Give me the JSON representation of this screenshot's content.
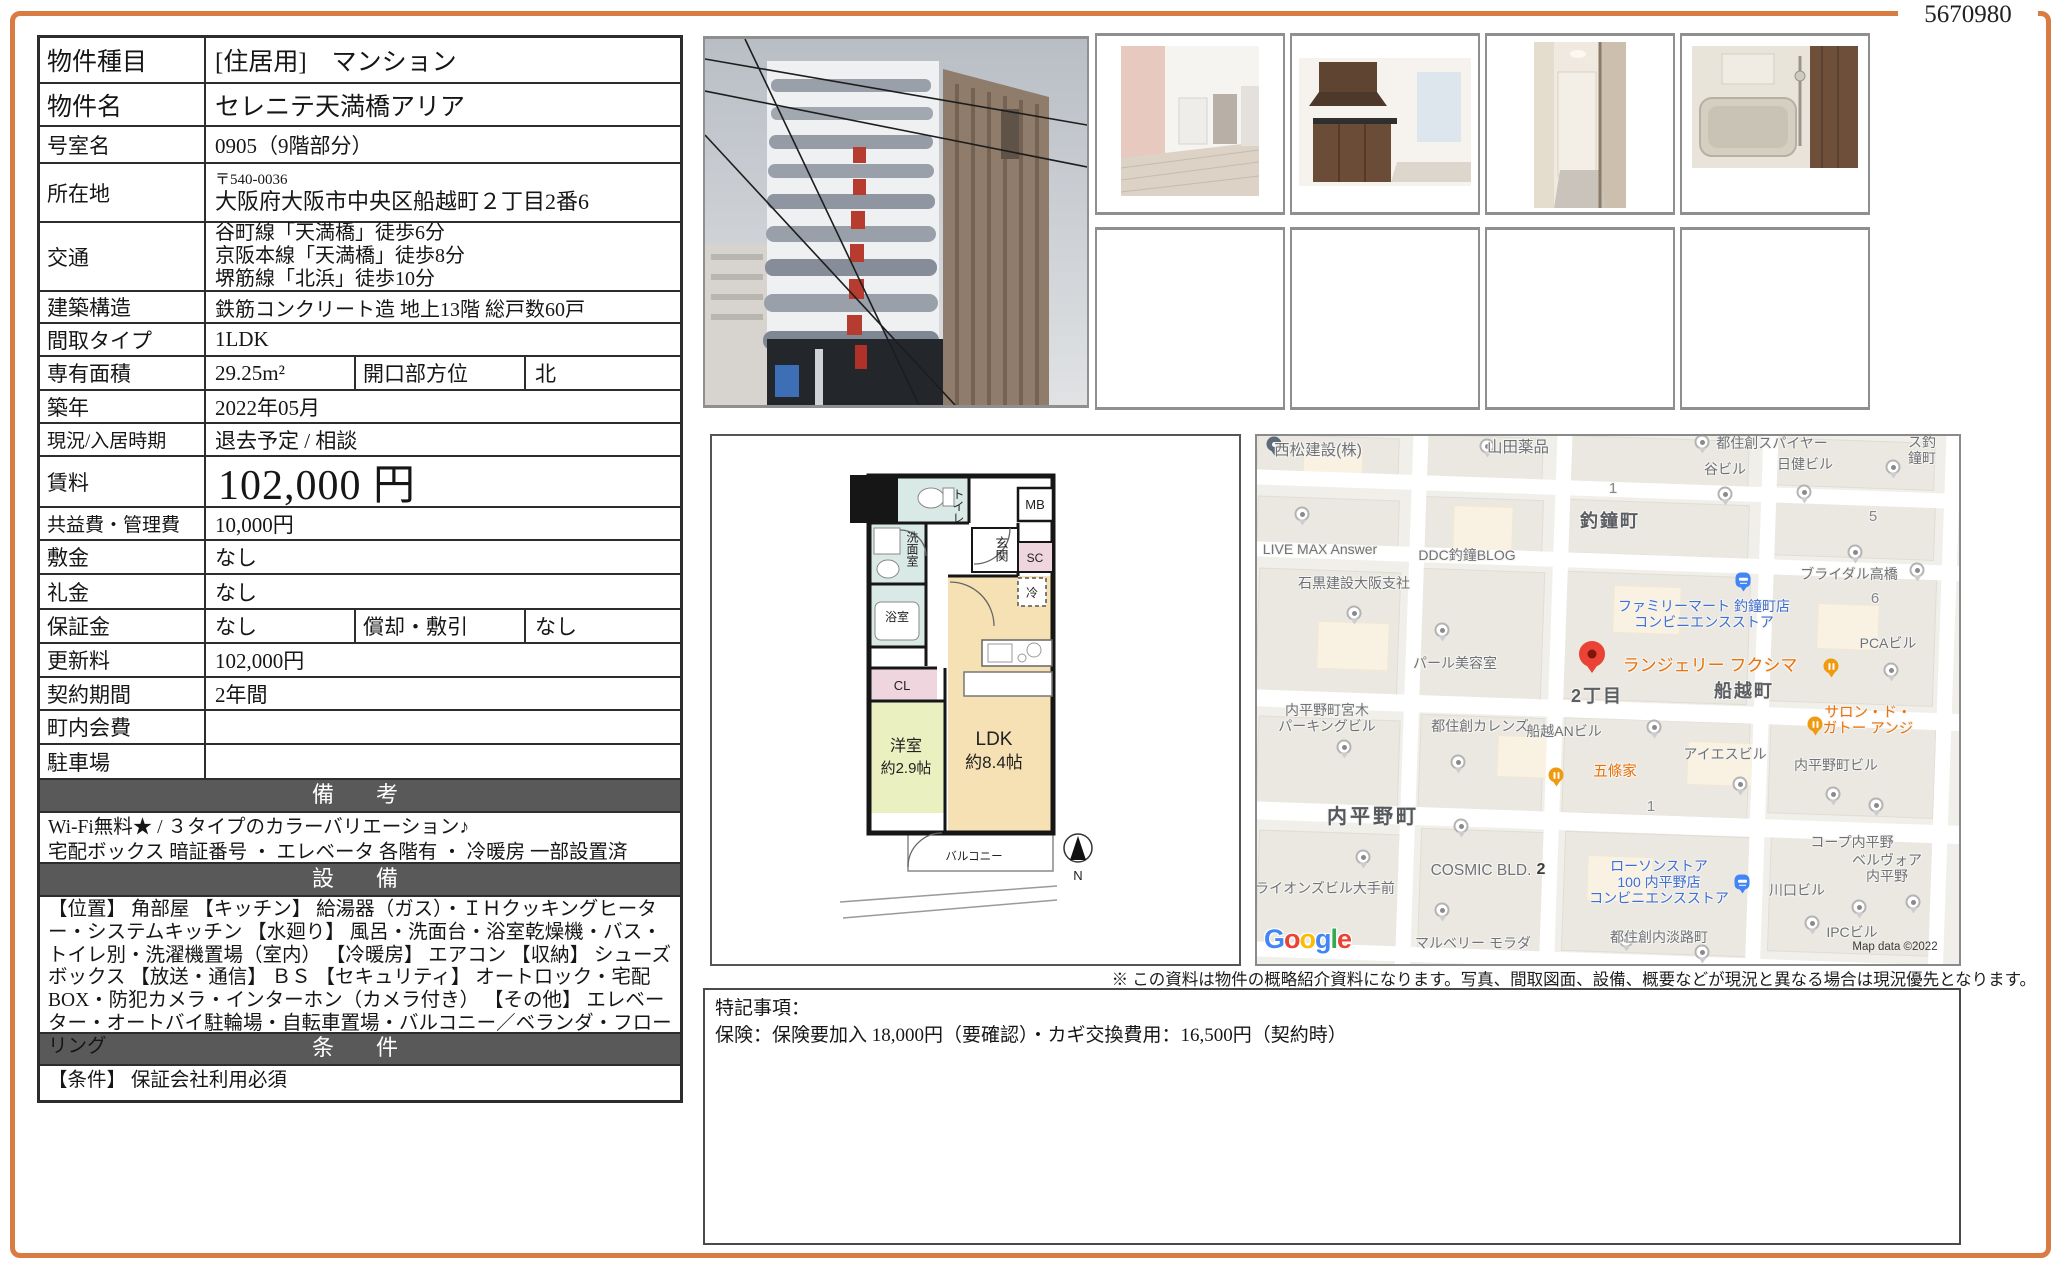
{
  "doc_number": "5670980",
  "table": {
    "rows": [
      {
        "label": "物件種目",
        "value": "[住居用]　マンション"
      },
      {
        "label": "物件名",
        "value": "セレニテ天満橋アリア"
      },
      {
        "label": "号室名",
        "value": "0905（9階部分）"
      },
      {
        "label": "所在地",
        "postal": "〒540-0036",
        "value": "大阪府大阪市中央区船越町２丁目2番6"
      },
      {
        "label": "交通",
        "value": "谷町線「天満橋」徒歩6分\n京阪本線「天満橋」徒歩8分\n堺筋線「北浜」徒歩10分"
      },
      {
        "label": "建築構造",
        "value": "鉄筋コンクリート造 地上13階  総戸数60戸"
      },
      {
        "label": "間取タイプ",
        "value": "1LDK"
      },
      {
        "label": "専有面積",
        "value": "29.25m²",
        "label2": "開口部方位",
        "value2": "北"
      },
      {
        "label": "築年",
        "value": "2022年05月"
      },
      {
        "label": "現況/入居時期",
        "value": "退去予定 /  相談"
      },
      {
        "label": "賃料",
        "value": "102,000 円"
      },
      {
        "label": "共益費・管理費",
        "value": "10,000円"
      },
      {
        "label": "敷金",
        "value": "なし"
      },
      {
        "label": "礼金",
        "value": "なし"
      },
      {
        "label": "保証金",
        "value": "なし",
        "label2": "償却・敷引",
        "value2": "なし"
      },
      {
        "label": "更新料",
        "value": "102,000円"
      },
      {
        "label": "契約期間",
        "value": "2年間"
      },
      {
        "label": "町内会費",
        "value": ""
      },
      {
        "label": "駐車場",
        "value": ""
      }
    ],
    "remarks_header": "備　考",
    "remarks_text": "Wi-Fi無料★ / ３タイプのカラーバリエーション♪\n宅配ボックス 暗証番号 ・ エレベータ 各階有 ・ 冷暖房 一部設置済",
    "equipment_header": "設　備",
    "equipment_text": "【位置】 角部屋 【キッチン】 給湯器（ガス）・ＩＨクッキングヒーター・システムキッチン 【水廻り】 風呂・洗面台・浴室乾燥機・バス・トイレ別・洗濯機置場（室内） 【冷暖房】 エアコン 【収納】 シューズボックス 【放送・通信】 ＢＳ 【セキュリティ】 オートロック・宅配BOX・防犯カメラ・インターホン（カメラ付き） 【その他】 エレベーター・オートバイ駐輪場・自転車置場・バルコニー／ベランダ・フローリング",
    "conditions_header": "条　件",
    "conditions_text": "【条件】 保証会社利用必須"
  },
  "floorplan": {
    "toilet": "トイレ",
    "mb": "MB",
    "washroom": "洗面室",
    "entrance": "玄関",
    "sc": "SC",
    "fridge": "冷",
    "bath": "浴室",
    "cl": "CL",
    "ldk": "LDK",
    "ldk_size": "約8.4帖",
    "western": "洋室",
    "western_size": "約2.9帖",
    "balcony": "バルコニー",
    "compass_n": "N"
  },
  "map": {
    "labels": [
      {
        "text": "西松建設(株)"
      },
      {
        "text": "山田薬品"
      },
      {
        "text": "都住創スパイヤー"
      },
      {
        "text": "ミネス釣鐘町"
      },
      {
        "text": "谷ビル"
      },
      {
        "text": "日健ビル"
      },
      {
        "text": "1"
      },
      {
        "text": "釣鐘町"
      },
      {
        "text": "5"
      },
      {
        "text": "LIVE MAX Answer"
      },
      {
        "text": "DDC釣鐘BLOG"
      },
      {
        "text": "石黒建設大阪支社"
      },
      {
        "text": "ブライダル高橋"
      },
      {
        "text": "6"
      },
      {
        "text": "ファミリーマート 釣鐘町店\nコンビニエンスストア"
      },
      {
        "text": "パール美容室"
      },
      {
        "text": "PCAビル"
      },
      {
        "text": "ランジェリー フクシマ"
      },
      {
        "text": "2丁目"
      },
      {
        "text": "船越町"
      },
      {
        "text": "サロン・ド・\nガトー アンジ"
      },
      {
        "text": "内平野町宮木\nパーキングビル"
      },
      {
        "text": "都住創カレンズ"
      },
      {
        "text": "船越ANビル"
      },
      {
        "text": "五條家"
      },
      {
        "text": "アイエスビル"
      },
      {
        "text": "内平野町ビル"
      },
      {
        "text": "内平野町"
      },
      {
        "text": "1"
      },
      {
        "text": "コープ内平野"
      },
      {
        "text": "ライオンズビル大手前"
      },
      {
        "text": "COSMIC BLD."
      },
      {
        "text": "2"
      },
      {
        "text": "ベルヴォア内平野"
      },
      {
        "text": "ローソンストア\n100 内平野店\nコンビニエンスストア"
      },
      {
        "text": "川口ビル"
      },
      {
        "text": "マルベリー モラダ"
      },
      {
        "text": "都住創内淡路町"
      },
      {
        "text": "IPCビル"
      },
      {
        "text": "Map data ©2022"
      }
    ],
    "google_letters": [
      "G",
      "o",
      "o",
      "g",
      "l",
      "e"
    ],
    "icons": {
      "restaurant_pin": "fork-knife",
      "convenience_pin": "store-front",
      "red_pin": "destination",
      "poi_pin": "dot"
    }
  },
  "disclaimer": "※ この資料は物件の概略紹介資料になります。写真、間取図面、設備、概要などが現況と異なる場合は現況優先となります。",
  "notes": {
    "title": "特記事項：",
    "body": "保険：保険要加入 18,000円（要確認）・カギ交換費用：16,500円（契約時）"
  }
}
